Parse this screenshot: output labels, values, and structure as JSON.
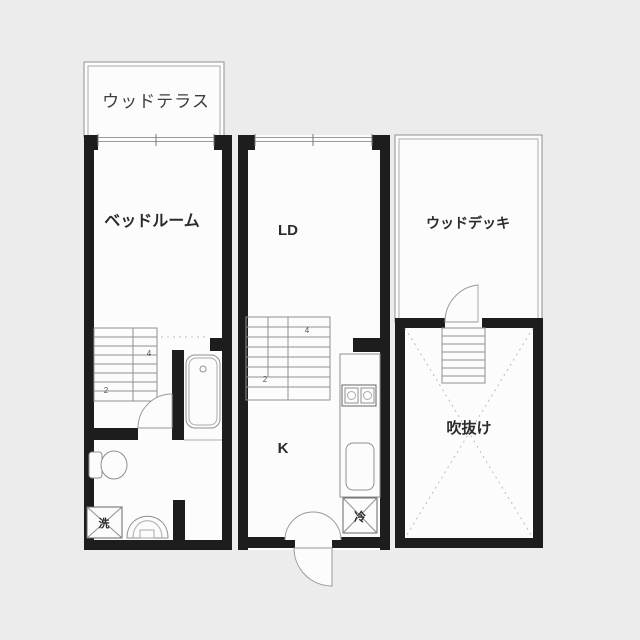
{
  "plan": {
    "title": "floor-plan",
    "colors": {
      "background": "#ececec",
      "floor": "#fcfcfc",
      "wall": "#1d1d1d",
      "line": "#8f8f8f",
      "dashed": "#bcbcbc",
      "text": "#2b2b2b"
    },
    "rooms": {
      "terrace": {
        "label": "ウッドテラス"
      },
      "bedroom": {
        "label": "ベッドルーム"
      },
      "living_dining": {
        "label": "LD"
      },
      "kitchen": {
        "label": "K"
      },
      "deck": {
        "label": "ウッドデッキ"
      },
      "void": {
        "label": "吹抜け"
      }
    },
    "fixtures": {
      "washer": {
        "label": "洗"
      },
      "fridge": {
        "label": "冷"
      }
    },
    "stairs": {
      "left_upper_number": "4",
      "left_lower_number": "2",
      "mid_upper_number": "4",
      "mid_lower_number": "2"
    }
  }
}
